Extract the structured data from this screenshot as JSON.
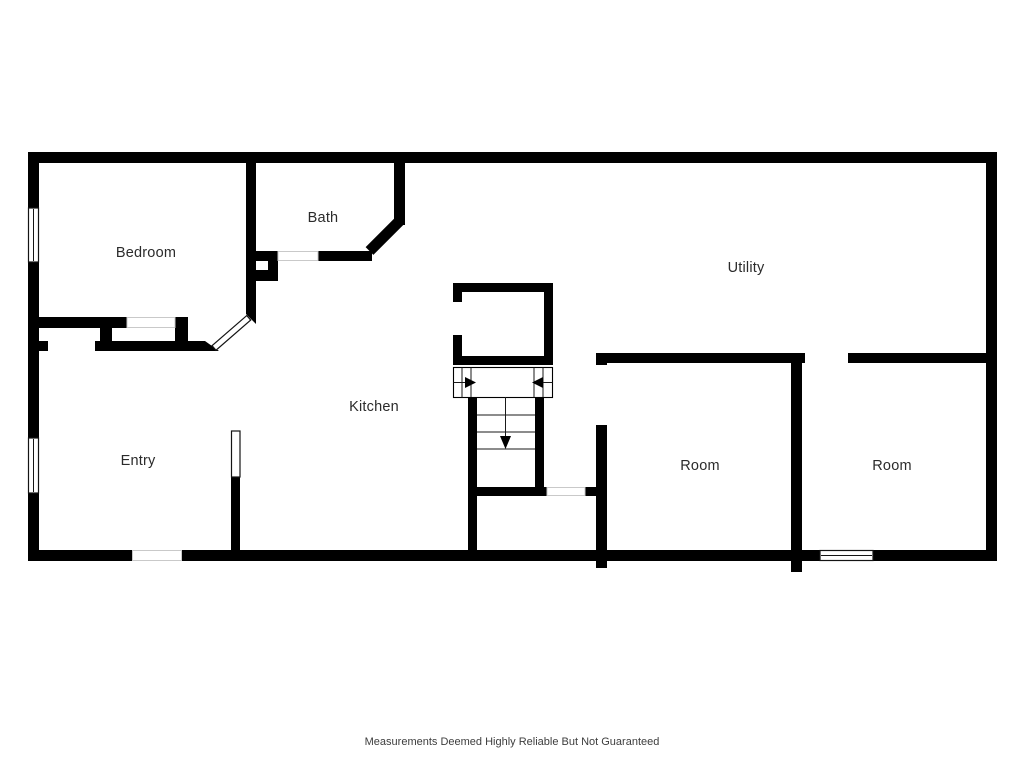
{
  "floor_plan": {
    "labels": {
      "bedroom": "Bedroom",
      "bath": "Bath",
      "utility": "Utility",
      "kitchen": "Kitchen",
      "entry": "Entry",
      "room_left": "Room",
      "room_right": "Room"
    },
    "disclaimer": "Measurements Deemed Highly Reliable But Not Guaranteed"
  },
  "icons": {
    "stair_arrow_right": "▶",
    "stair_arrow_left": "◀",
    "stair_arrow_down": "▼"
  },
  "colors": {
    "wall": "#000000",
    "background": "#ffffff",
    "label_text": "#2b2b2b",
    "disclaimer_text": "#3d3d3d",
    "casing_line": "#c9c9c9",
    "window_line": "#141414"
  }
}
